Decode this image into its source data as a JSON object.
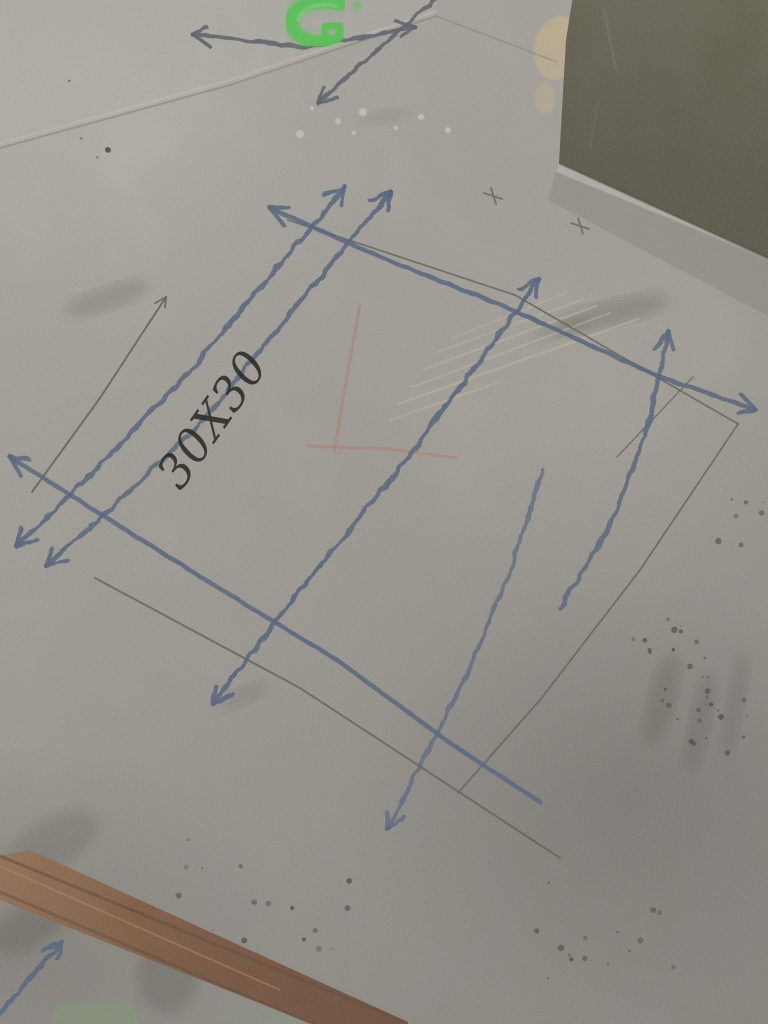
{
  "scene": {
    "type": "photograph",
    "subject": "bare concrete floor with construction chalk layout grid, hand-drawn arrows and a handwritten dimension",
    "annotation": {
      "text": "30X30"
    },
    "colors": {
      "concrete_base": "#a5a19a",
      "concrete_light": "#bdb9b1",
      "concrete_dark": "#827e78",
      "chalk_blue": "#3a5174",
      "chalk_blue_dark": "#454e5c",
      "pencil": "#4a463f",
      "chalk_red": "#bf6a52",
      "spray_green": "#3cd63c",
      "spray_green_bright": "#67e55f",
      "panel_olive_1": "#56523f",
      "panel_olive_2": "#45422f",
      "panel_olive_3": "#3e3c2b",
      "wood_1": "#8f613c",
      "wood_2": "#6b3d1f",
      "wood_3": "#59301a",
      "wood_edge": "#4a2a14",
      "wood_highlight": "#b08656",
      "scuff_tan": "#d3c29b",
      "seam_dark": "#7d7a73",
      "seam_light": "#cfcbc2",
      "moss_green": "#7a9a6e",
      "speck_white": "#dedacf",
      "splatter_dark": "#26241f",
      "smudge": "#3a3833",
      "tan_patch": "#d2bc8c"
    },
    "objects": [
      {
        "name": "concrete-floor",
        "label": "bare concrete slab"
      },
      {
        "name": "door-panel",
        "label": "dark olive panel leaning at top right"
      },
      {
        "name": "green-spray-mark",
        "label": "bright green spray paint mark at top"
      },
      {
        "name": "chalk-grid",
        "label": "blue chalk layout lines with hand-drawn arrowheads"
      },
      {
        "name": "pencil-lines",
        "label": "thin pencil reference lines and layout square"
      },
      {
        "name": "red-chalk-lines",
        "label": "faint red chalk corner lines"
      },
      {
        "name": "dimension-annotation",
        "label": "handwritten size marking 30X30"
      },
      {
        "name": "wood-strip",
        "label": "wooden batten at bottom left"
      },
      {
        "name": "paint-splatter",
        "label": "dark paint splatter dots"
      }
    ]
  },
  "markings": {
    "lines": [
      {
        "name": "top-line-horizontal",
        "layer": "chalk",
        "color": "chalk_blue_dark",
        "width": 4,
        "opacity": 0.9,
        "points": [
          [
            192,
            34
          ],
          [
            305,
            47
          ],
          [
            415,
            27
          ]
        ],
        "arrow_start": true,
        "arrow_end": true
      },
      {
        "name": "top-line-diagonal",
        "layer": "chalk",
        "color": "chalk_blue_dark",
        "width": 4,
        "opacity": 0.9,
        "points": [
          [
            447,
            -12
          ],
          [
            380,
            48
          ],
          [
            318,
            103
          ]
        ],
        "arrow_start": false,
        "arrow_end": true
      },
      {
        "name": "chalk-column-1a",
        "layer": "chalk",
        "color": "chalk_blue",
        "width": 4.5,
        "opacity": 0.88,
        "points": [
          [
            345,
            187
          ],
          [
            282,
            262
          ],
          [
            196,
            364
          ],
          [
            96,
            470
          ],
          [
            16,
            546
          ]
        ],
        "arrow_start": true,
        "arrow_end": true
      },
      {
        "name": "chalk-column-1b",
        "layer": "chalk",
        "color": "chalk_blue",
        "width": 4.5,
        "opacity": 0.88,
        "points": [
          [
            391,
            192
          ],
          [
            305,
            295
          ],
          [
            203,
            420
          ],
          [
            106,
            513
          ],
          [
            46,
            566
          ]
        ],
        "arrow_start": true,
        "arrow_end": true
      },
      {
        "name": "chalk-column-2",
        "layer": "chalk",
        "color": "chalk_blue",
        "width": 4.5,
        "opacity": 0.88,
        "points": [
          [
            539,
            279
          ],
          [
            480,
            360
          ],
          [
            388,
            483
          ],
          [
            292,
            600
          ],
          [
            213,
            704
          ]
        ],
        "arrow_start": true,
        "arrow_end": true
      },
      {
        "name": "chalk-column-2b",
        "layer": "chalk",
        "color": "chalk_blue",
        "width": 4.2,
        "opacity": 0.72,
        "points": [
          [
            543,
            470
          ],
          [
            512,
            566
          ],
          [
            466,
            678
          ],
          [
            387,
            829
          ]
        ],
        "arrow_start": false,
        "arrow_end": true
      },
      {
        "name": "chalk-column-3",
        "layer": "chalk",
        "color": "chalk_blue",
        "width": 4.5,
        "opacity": 0.85,
        "points": [
          [
            669,
            332
          ],
          [
            648,
            425
          ],
          [
            613,
            520
          ],
          [
            560,
            608
          ]
        ],
        "arrow_start": true,
        "arrow_end": false
      },
      {
        "name": "chalk-row-1",
        "layer": "chalk",
        "color": "chalk_blue",
        "width": 4.5,
        "opacity": 0.88,
        "points": [
          [
            270,
            208
          ],
          [
            380,
            257
          ],
          [
            513,
            310
          ],
          [
            660,
            377
          ],
          [
            756,
            410
          ]
        ],
        "arrow_start": true,
        "arrow_end": true
      },
      {
        "name": "chalk-row-2",
        "layer": "chalk",
        "color": "chalk_blue",
        "width": 4.5,
        "opacity": 0.86,
        "points": [
          [
            10,
            457
          ],
          [
            199,
            576
          ],
          [
            337,
            660
          ],
          [
            450,
            743
          ],
          [
            540,
            802
          ]
        ],
        "arrow_start": true,
        "arrow_end": false
      },
      {
        "name": "chalk-bottom-left-line",
        "layer": "chalk",
        "color": "chalk_blue",
        "width": 4.5,
        "opacity": 0.88,
        "points": [
          [
            62,
            942
          ],
          [
            28,
            980
          ],
          [
            -6,
            1022
          ]
        ],
        "arrow_start": true,
        "arrow_end": false
      },
      {
        "name": "pencil-arrow-line",
        "layer": "pencil",
        "color": "pencil",
        "width": 2,
        "opacity": 0.85,
        "points": [
          [
            32,
            492
          ],
          [
            100,
            398
          ],
          [
            166,
            297
          ]
        ],
        "arrow_start": false,
        "arrow_end": true
      },
      {
        "name": "pencil-square-top",
        "layer": "pencil",
        "color": "pencil",
        "width": 1.8,
        "opacity": 0.8,
        "points": [
          [
            288,
            220
          ],
          [
            515,
            295
          ],
          [
            738,
            424
          ]
        ],
        "arrow_start": false,
        "arrow_end": false
      },
      {
        "name": "pencil-square-right",
        "layer": "pencil",
        "color": "pencil",
        "width": 1.8,
        "opacity": 0.8,
        "points": [
          [
            738,
            424
          ],
          [
            640,
            570
          ],
          [
            540,
            700
          ],
          [
            458,
            793
          ]
        ],
        "arrow_start": false,
        "arrow_end": false
      },
      {
        "name": "pencil-long-line",
        "layer": "pencil",
        "color": "pencil",
        "width": 2,
        "opacity": 0.8,
        "points": [
          [
            95,
            578
          ],
          [
            300,
            688
          ],
          [
            560,
            858
          ]
        ],
        "arrow_start": false,
        "arrow_end": false
      },
      {
        "name": "pencil-short-line",
        "layer": "pencil",
        "color": "pencil",
        "width": 1.6,
        "opacity": 0.7,
        "points": [
          [
            693,
            377
          ],
          [
            617,
            457
          ]
        ],
        "arrow_start": false,
        "arrow_end": false
      },
      {
        "name": "red-chalk-vertical",
        "layer": "red",
        "color": "chalk_red",
        "width": 3,
        "opacity": 0.45,
        "points": [
          [
            360,
            305
          ],
          [
            348,
            370
          ],
          [
            334,
            452
          ]
        ],
        "arrow_start": false,
        "arrow_end": false
      },
      {
        "name": "red-chalk-horizontal",
        "layer": "red",
        "color": "chalk_red",
        "width": 3,
        "opacity": 0.45,
        "points": [
          [
            308,
            446
          ],
          [
            390,
            449
          ],
          [
            456,
            458
          ]
        ],
        "arrow_start": false,
        "arrow_end": false
      },
      {
        "name": "scuff-1",
        "layer": "scuff",
        "color": "scuff_tan",
        "width": 2.5,
        "opacity": 0.55,
        "points": [
          [
            398,
            404
          ],
          [
            638,
            319
          ]
        ],
        "arrow_start": false,
        "arrow_end": false
      },
      {
        "name": "scuff-2",
        "layer": "scuff",
        "color": "scuff_tan",
        "width": 2.2,
        "opacity": 0.5,
        "points": [
          [
            412,
            387
          ],
          [
            610,
            313
          ]
        ],
        "arrow_start": false,
        "arrow_end": false
      },
      {
        "name": "scuff-3",
        "layer": "scuff",
        "color": "scuff_tan",
        "width": 2.5,
        "opacity": 0.5,
        "points": [
          [
            424,
            369
          ],
          [
            596,
            306
          ]
        ],
        "arrow_start": false,
        "arrow_end": false
      },
      {
        "name": "scuff-4",
        "layer": "scuff",
        "color": "scuff_tan",
        "width": 2,
        "opacity": 0.45,
        "points": [
          [
            438,
            352
          ],
          [
            584,
            299
          ]
        ],
        "arrow_start": false,
        "arrow_end": false
      },
      {
        "name": "scuff-5",
        "layer": "scuff",
        "color": "scuff_tan",
        "width": 2,
        "opacity": 0.45,
        "points": [
          [
            452,
            338
          ],
          [
            566,
            293
          ]
        ],
        "arrow_start": false,
        "arrow_end": false
      },
      {
        "name": "scuff-6",
        "layer": "scuff",
        "color": "scuff_tan",
        "width": 2.5,
        "opacity": 0.45,
        "points": [
          [
            390,
            420
          ],
          [
            500,
            382
          ]
        ],
        "arrow_start": false,
        "arrow_end": false
      },
      {
        "name": "seam-upper",
        "layer": "bg",
        "color": "seam_dark",
        "width": 2,
        "opacity": 0.6,
        "points": [
          [
            0,
            148
          ],
          [
            230,
            85
          ],
          [
            436,
            16
          ]
        ],
        "arrow_start": false,
        "arrow_end": false
      },
      {
        "name": "seam-upper-highlight",
        "layer": "bg",
        "color": "seam_light",
        "width": 2.5,
        "opacity": 0.55,
        "points": [
          [
            0,
            143
          ],
          [
            230,
            80
          ],
          [
            436,
            11
          ]
        ],
        "arrow_start": false,
        "arrow_end": false
      },
      {
        "name": "seam-right",
        "layer": "bg",
        "color": "seam_dark",
        "width": 2,
        "opacity": 0.5,
        "points": [
          [
            436,
            16
          ],
          [
            557,
            62
          ]
        ],
        "arrow_start": false,
        "arrow_end": false
      }
    ],
    "crosses": [
      {
        "x": 493,
        "y": 196
      },
      {
        "x": 580,
        "y": 226
      }
    ],
    "smudges": [
      {
        "cx": 108,
        "cy": 298,
        "rx": 46,
        "ry": 12,
        "rot": -18,
        "o": 0.22
      },
      {
        "cx": 612,
        "cy": 313,
        "rx": 58,
        "ry": 13,
        "rot": -14,
        "o": 0.28
      },
      {
        "cx": 560,
        "cy": 330,
        "rx": 30,
        "ry": 8,
        "rot": -14,
        "o": 0.2
      },
      {
        "cx": 662,
        "cy": 700,
        "rx": 14,
        "ry": 48,
        "rot": 14,
        "o": 0.28
      },
      {
        "cx": 700,
        "cy": 722,
        "rx": 11,
        "ry": 52,
        "rot": 12,
        "o": 0.25
      },
      {
        "cx": 735,
        "cy": 705,
        "rx": 9,
        "ry": 55,
        "rot": 10,
        "o": 0.22
      },
      {
        "cx": 243,
        "cy": 696,
        "rx": 28,
        "ry": 9,
        "rot": -22,
        "o": 0.18
      },
      {
        "cx": 168,
        "cy": 975,
        "rx": 30,
        "ry": 38,
        "rot": 0,
        "o": 0.3
      },
      {
        "cx": 30,
        "cy": 925,
        "rx": 48,
        "ry": 22,
        "rot": -28,
        "o": 0.3
      },
      {
        "cx": 385,
        "cy": 116,
        "rx": 26,
        "ry": 7,
        "rot": -12,
        "o": 0.15
      },
      {
        "cx": 50,
        "cy": 845,
        "rx": 55,
        "ry": 25,
        "rot": -30,
        "o": 0.22
      }
    ],
    "specks": [
      {
        "x": 312,
        "y": 108
      },
      {
        "x": 338,
        "y": 121
      },
      {
        "x": 363,
        "y": 112
      },
      {
        "x": 396,
        "y": 128
      },
      {
        "x": 421,
        "y": 117
      },
      {
        "x": 300,
        "y": 134
      },
      {
        "x": 354,
        "y": 133
      },
      {
        "x": 448,
        "y": 130
      }
    ],
    "splatter_clusters": [
      {
        "x": 700,
        "y": 712,
        "s": 60,
        "n": 22
      },
      {
        "x": 612,
        "y": 950,
        "s": 110,
        "n": 16
      },
      {
        "x": 215,
        "y": 882,
        "s": 70,
        "n": 9
      },
      {
        "x": 362,
        "y": 940,
        "s": 85,
        "n": 9
      },
      {
        "x": 744,
        "y": 505,
        "s": 42,
        "n": 7
      },
      {
        "x": 672,
        "y": 652,
        "s": 40,
        "n": 12
      },
      {
        "x": 105,
        "y": 120,
        "s": 60,
        "n": 6
      }
    ]
  }
}
